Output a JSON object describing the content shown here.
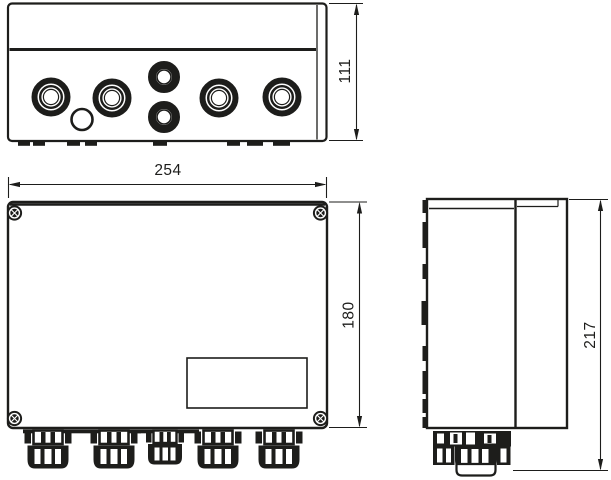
{
  "drawing": {
    "kind": "technical-drawing",
    "background": "#ffffff",
    "line_color": "#1d1d1b",
    "dimensions": {
      "front_width": "254",
      "front_height": "180",
      "top_depth": "111",
      "side_height": "217"
    }
  }
}
